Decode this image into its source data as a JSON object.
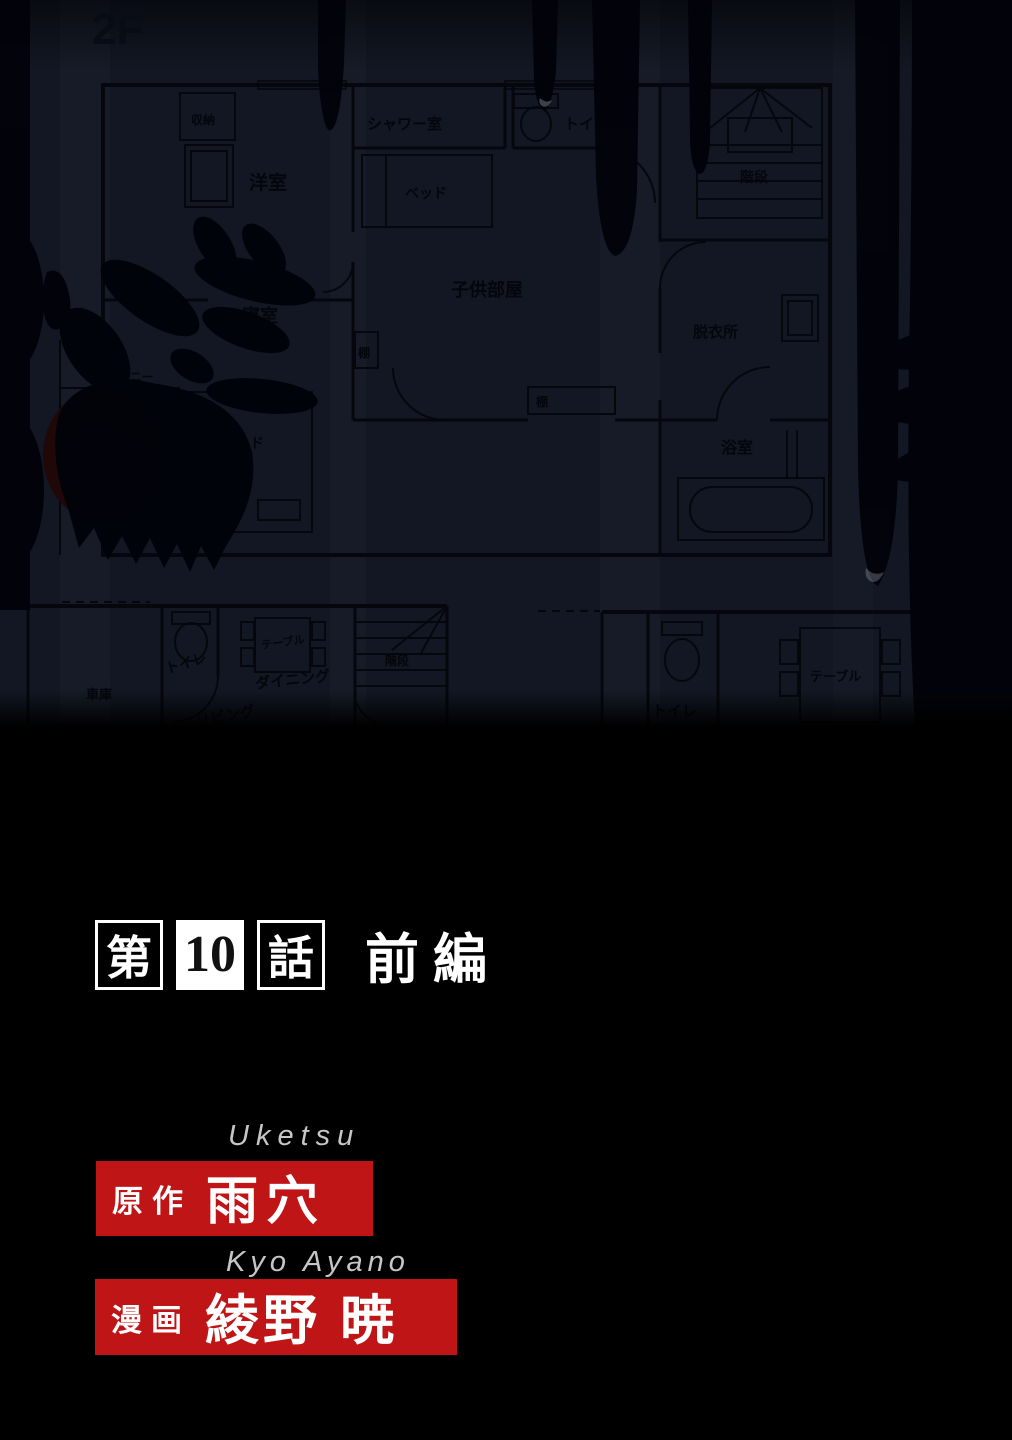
{
  "page": {
    "floor_label": "2F",
    "episode": {
      "prefix": "第",
      "number": "10",
      "suffix": "話",
      "part": "前編"
    },
    "credits": [
      {
        "romaji": "Uketsu",
        "role": "原作",
        "name": "雨穴"
      },
      {
        "romaji": "Kyo Ayano",
        "role": "漫画",
        "name": "綾野 暁"
      }
    ],
    "colors": {
      "accent_red": "#bf1517",
      "plan_background": "#121723",
      "blood_black": "#02030a"
    }
  },
  "plan_labels": {
    "floor": "2F",
    "closet": "収納",
    "western_room": "洋室",
    "shower_room": "シャワー室",
    "toilet_2f": "トイレ",
    "bed_childrens": "ベッド",
    "childrens_room": "子供部屋",
    "stairs_2f": "階段",
    "dressing_room": "脱衣所",
    "shelf_1": "棚",
    "shelf_2": "棚",
    "bedroom": "寝室",
    "bed_bedroom": "ベッド",
    "balcony": "バルコニー",
    "bathroom": "浴室",
    "garage": "車庫",
    "toilet_1f_left": "トイレ",
    "table_dining": "テーブル",
    "dining": "ダイニング",
    "living": "リビング",
    "stairs_1f": "階段",
    "toilet_1f_right": "トイレ",
    "table_right": "テーブル"
  }
}
